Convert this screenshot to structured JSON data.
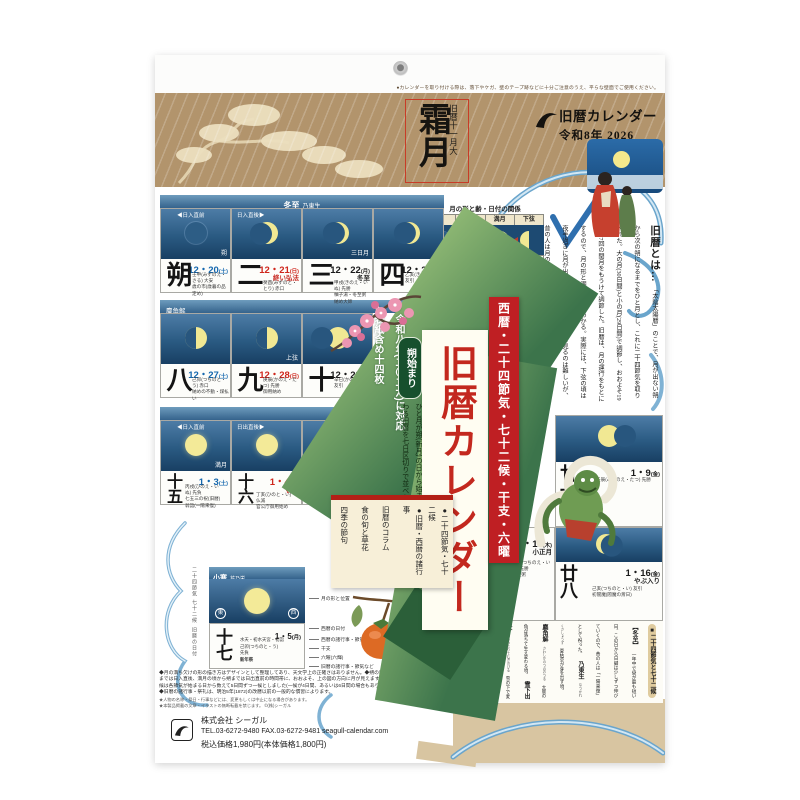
{
  "misc": {
    "caution": "●カレンダーを取り付ける際は、落下やケガ、壁のテープ跡などに十分ご注意のうえ、平らな壁面でご使用ください。"
  },
  "header": {
    "month_label": "旧暦十一月大",
    "month_kanji": "霜月",
    "brand1": "旧暦カレンダー",
    "brand2": "令和8年 2026"
  },
  "diagram": {
    "title": "月の形と齢・日付の関係",
    "p1": "朔",
    "p2": "上弦",
    "p3": "満月",
    "p4": "下弦",
    "t1": "大潮",
    "t2": "小潮",
    "t3": "大潮",
    "t4": "小潮",
    "a1": "一日・三十日頃",
    "a2": "七・八日頃",
    "a3": "十四〜十六日頃",
    "a4": "二十二・二十三日頃"
  },
  "about": {
    "title": "旧暦とは…",
    "body": "「太陰太陽暦」のことで、月が出ない朔から次の朔になるまでをひと月とし、これに二十四節気を取り入れた。大の月(30日間)と小の月(29日間)で調節し、おおよそ19年に7回の閏月をもうけて調節した。旧暦は、月の運行をもとにするので、月の形と潮の状態がわかる。実際には、下弦の頃は夜半過ぎに月が出るので、毎夜、月の姿を見るのは難しいが、昔の人は月の形で、月が何日なのかを知っていたのである。"
  },
  "cal": {
    "r1": {
      "sekki": "冬至",
      "kou": "乃東生",
      "ml": "◀日入直前",
      "mr": "日入直後▶",
      "c1": {
        "num": "朔",
        "date": "12・20",
        "wd": "(土)",
        "label": "朔",
        "n1": "壬申(みずのえ・さる) 大安",
        "n2": "歳の市(歳暮の品定め)"
      },
      "c2": {
        "num": "二",
        "date": "12・21",
        "wd": "(日)",
        "event": "終い弘法",
        "n1": "癸酉(みずのと・とり) 赤口"
      },
      "c3": {
        "num": "三",
        "date": "12・22",
        "wd": "(月)",
        "event": "冬至",
        "label": "三日月",
        "n1": "甲戌(きのえ・いぬ) 先勝",
        "n2": "柚子湯・冬至粥",
        "n3": "納め大師"
      },
      "c4": {
        "num": "四",
        "date": "12・23",
        "wd": "(火)",
        "n1": "乙亥(きのと・い) 友引"
      }
    },
    "r2": {
      "kou": "麋角解",
      "c1": {
        "num": "八",
        "date": "12・27",
        "wd": "(土)",
        "n1": "己卯(つちのと・う) 赤口",
        "n2": "納めの不動・煤払い"
      },
      "c2": {
        "num": "九",
        "date": "12・28",
        "wd": "(日)",
        "label": "上弦",
        "n1": "庚辰(かのえ・たつ) 先勝",
        "n2": "御用納め"
      },
      "c3": {
        "num": "十",
        "date": "12・29",
        "wd": "(月)",
        "n1": "辛巳(かのと・み) 友引"
      }
    },
    "r3": {
      "sekki": "小寒",
      "kou": "芹乃栄",
      "ml": "◀日入直前",
      "mr": "日出直後▶",
      "c1": {
        "num": "十五",
        "date": "1・3",
        "wd": "(土)",
        "label": "満月",
        "n1": "丙戌(ひのえ・いぬ) 先負",
        "n2": "七五三の祝(旧暦)",
        "n3": "翁詣(一陽来復)"
      },
      "c2": {
        "num": "十六",
        "date": "1・4",
        "wd": "(日)",
        "event": "初荷",
        "n1": "丁亥(ひのと・い) 仏滅",
        "n2": "官公庁御用始め"
      },
      "c3": {
        "num": "十七",
        "date": "1・5",
        "wd": "(月)"
      }
    },
    "right": {
      "c21": {
        "num": "廿一",
        "date": "1・9",
        "wd": "(金)",
        "n1": "壬辰(みずのえ・たつ) 先勝"
      },
      "c27": {
        "num": "廿七",
        "date": "1・15",
        "wd": "(木)",
        "event": "小正月",
        "n1": "戊戌(つちのえ・いぬ) 先勝",
        "n2": "小豆粥"
      },
      "c28": {
        "num": "廿八",
        "date": "1・16",
        "wd": "(金)",
        "event": "やぶ入り",
        "n1": "己亥(つちのと・い) 友引",
        "n2": "初閻魔(閻魔の斎日)"
      }
    }
  },
  "legend": {
    "side_top": "二十四節気 七十二候",
    "side_bottom": "旧暦の日付",
    "sekki": "小寒",
    "kou": "芹乃栄",
    "num": "十七",
    "date": "1・5",
    "wd": "(月)",
    "east": "東",
    "west": "西",
    "s1": "水天・初水天宮・初詣",
    "s2": "己卯(つちのと・う)",
    "s3": "先負",
    "s4": "新年祭",
    "a_moon": "月の形と位置",
    "a_date": "西暦の日付",
    "a_ev_new": "西暦の諸行事・節気など",
    "a_eto": "干支",
    "a_rokuyo": "六曜(六輝)",
    "a_ev_old": "旧暦の諸行事・節気など"
  },
  "ribbon": {
    "badge": "朔始まり",
    "desc": "ひと月が朔(新月)の日から始まり、次の朔の前日で終わる旧暦を七日区切りで並べたカレンダーです。",
    "f1": "●令和八年(二〇二六)に対応",
    "f2": "●表紙含め十四枚"
  },
  "banner": {
    "red": "西暦・二十四節気・七十二候・干支・六曜",
    "white": "旧暦カレンダー"
  },
  "box": {
    "i1": "●月名の主な別名",
    "i2": "●二十四節気・七十二候",
    "i3": "●旧暦・西暦の諸行事",
    "i4": "旧暦のコラム",
    "i5": "食の旬と草花",
    "i6": "四季の節句"
  },
  "art": {
    "h1": "■二十四節気と七十二候",
    "tj": "【冬至】",
    "tjb": "一年中で昼が最も短い日。この日から日脚は少しずつ伸びていくので、昔の人は「一陽来復」として祝った。",
    "e1n": "乃東生",
    "e1y": "なつかれくさしょうず",
    "e1d": "夏枯草が芽を出す頃。",
    "e2n": "麋角解",
    "e2y": "さわしかのつのおつる",
    "e2d": "大鹿の角が落ちて生え変わる頃。",
    "e3n": "雪下出麦",
    "e3y": "ゆきわたりてむぎのびる",
    "e3d": "雪の下で麦が芽を出す頃。",
    "sk": "【小寒】",
    "skb": "「寒の入り」のこと。この日から節分までが「寒」で、寒中見舞いはこの間に出す。",
    "e4n": "芹乃栄",
    "e4y": "せりすなわちさかう",
    "e4d": "芹がよく生育する頃。",
    "e5n": "水泉動",
    "e5y": "しみずあたたかをふくむ",
    "e5d": "地中で凍った泉が動き始める頃。",
    "e6n": "雉始雊",
    "e6y": "きじはじめてなく",
    "e6d": "雄の雉が鳴き始める頃。",
    "h2": "■霜月の出来事",
    "evt": "〔坂本龍馬、三十一歳で没する〕",
    "evb": "慶応三年の十一月十五日の夜、京都・近江屋で、日本の将来を見据え、薩長同盟や大政奉還など幕末の政局を動かした坂本龍馬が、中岡慎太郎とともに刺客に襲われ落命した。新時代の夜明けを目前にした、あまりにも早い死であった。"
  },
  "fp": {
    "l1": "◆月の満ち欠けの形の描き方はデザインとして整理してあり、天文学上の正確さはありません。◆朔の頃から満月",
    "l2": "までは日入直後、満月の頃から朔までは日出直前の時間帯に、おおよそ、上の図の方向に月が見えます。◆七十二",
    "l3": "候は各節気が始まる日から数えて5日間ずつ一候としました(一候が4日間、あるいは6日間の場合もあります)。",
    "l4": "◆旧暦の諸行事・祭礼は、明治5年(1872)の改暦以前の一般的な慣習によります。",
    "s1": "★人物の名称・祭日・行事などには、変更もしくは中止になる場合があります。",
    "s2": "★本製品掲載の文章・イラストの無断転載を禁じます。 ©(株)シーガル"
  },
  "co": {
    "name": "株式会社 シーガル",
    "tel": "TEL.03-6272-9480  FAX.03-6272-9481  seagull-calendar.com",
    "price": "税込価格1,980円(本体価格1,800円)"
  }
}
